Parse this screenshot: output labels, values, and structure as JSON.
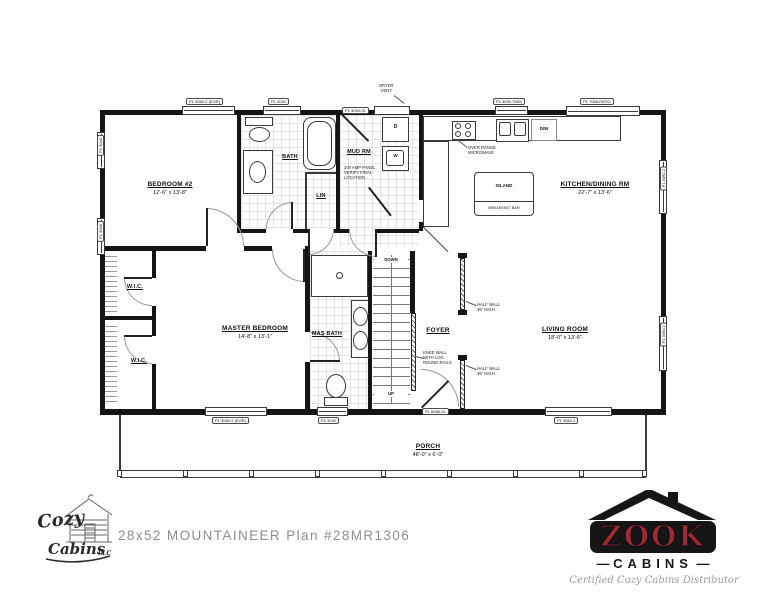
{
  "plan": {
    "rooms": {
      "bedroom2": {
        "name": "BEDROOM #2",
        "dims": "12'-6\" x 13'-8\""
      },
      "bath": {
        "name": "BATH"
      },
      "lin": {
        "name": "LIN"
      },
      "mud": {
        "name": "MUD RM"
      },
      "kitchen": {
        "name": "KITCHEN/DINING RM",
        "dims": "22'-7\" x 13'-6\""
      },
      "wic1": {
        "name": "W.I.C."
      },
      "wic2": {
        "name": "W.I.C."
      },
      "master": {
        "name": "MASTER BEDROOM",
        "dims": "14'-8\" x 13'-1\""
      },
      "masbath": {
        "name": "MAS BATH"
      },
      "foyer": {
        "name": "FOYER"
      },
      "living": {
        "name": "LIVING ROOM",
        "dims": "18'-0\" x 13'-6\""
      },
      "porch": {
        "name": "PORCH",
        "dims": "48'-0\" x 6'-0\""
      }
    },
    "labels": {
      "dryer": "D",
      "washer": "W",
      "dishwasher": "D/W",
      "island": "ISLAND",
      "breakfast_bar": "BREAKFAST BAR",
      "down": "DOWN",
      "up": "UP"
    },
    "notes": {
      "microwave": "OVER RANGE\nMICROWAVE",
      "panel": "200 AMP PANEL\nVERIFY FINAL\nLOCATION",
      "half_wall_upper": "HALF WALL\n36\" HIGH",
      "half_wall_lower": "HALF WALL\n36\" HIGH",
      "knee_wall": "KNEE WALL\nWITH LOG\nROUND RAILS",
      "dryer_vent": "DRYER\nVENT"
    },
    "openings": {
      "top_bedroom2": "P1 3060-2 (EGR)",
      "top_bath": "P1 3040",
      "top_mud": "P1 3050-SL",
      "top_kitchen": "P1 3030 TWIN",
      "top_patio": "P1 7068-PATIO",
      "right_upper": "P1 3060-2",
      "right_lower": "P1 3060-2",
      "left_upper": "P1 3040",
      "left_lower": "P1 3040",
      "bottom_master": "P1 3060-2 (EGR)",
      "bottom_masbath": "P1 3040",
      "bottom_front": "P1 6068-SL",
      "bottom_living": "P1 3060-2"
    }
  },
  "footer": {
    "plan_title": "28x52 MOUNTAINEER  Plan #28MR1306",
    "cozy_logo": {
      "word1": "Cozy",
      "word2": "Cabins",
      "suffix": "LLC"
    },
    "zook_logo": {
      "word": "ZOOK",
      "sub": "CABINS",
      "tagline": "Certified Cozy Cabins Distributor",
      "red": "#9e2a33"
    }
  }
}
